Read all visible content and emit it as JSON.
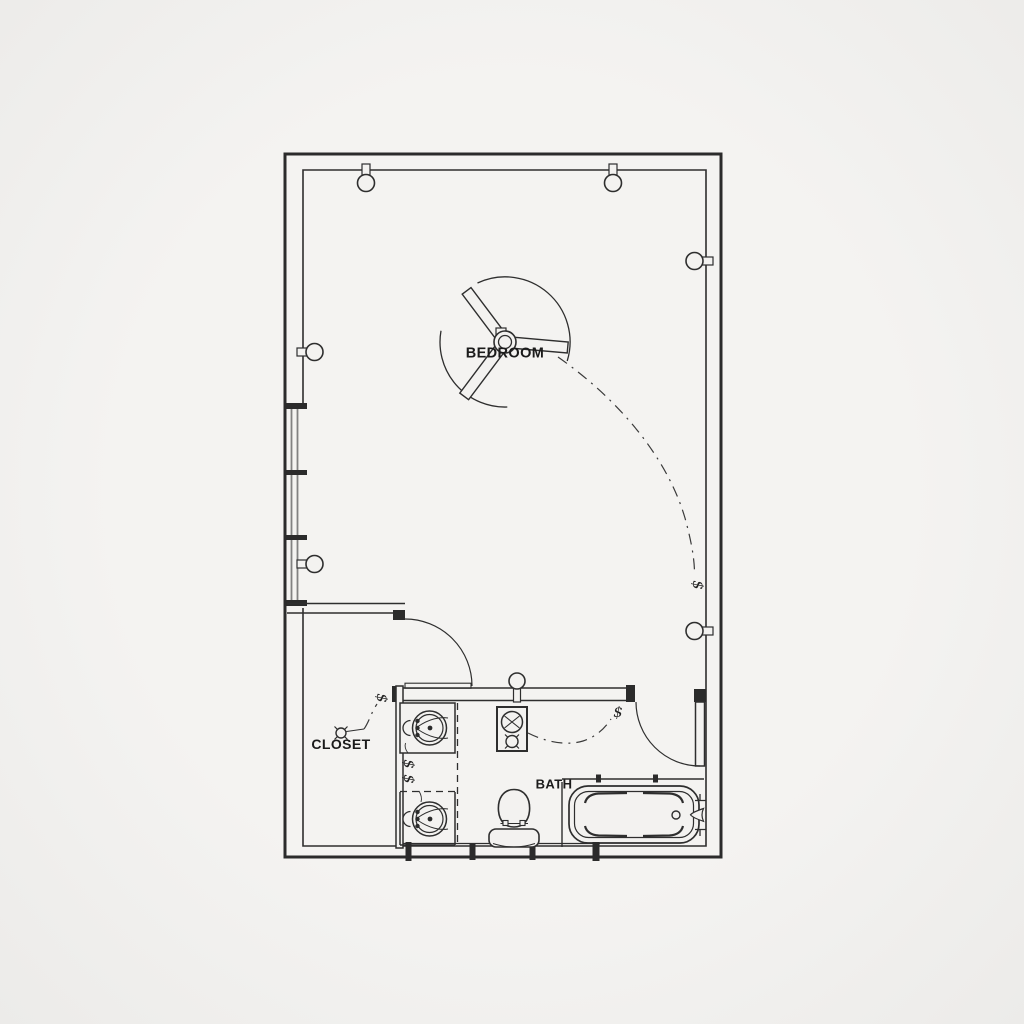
{
  "colors": {
    "background": "#f3f2f0",
    "line": "#2b2b2b",
    "glazing_gray": "#828282",
    "text": "#1b1b1b"
  },
  "rooms": {
    "bedroom": {
      "label": "BEDROOM"
    },
    "closet": {
      "label": "CLOSET"
    },
    "bath": {
      "label": "BATH"
    }
  },
  "electrical": {
    "switch_glyph": "$",
    "switches": [
      {
        "id": "closet-switch",
        "label": "$",
        "location": "at closet door jamb"
      },
      {
        "id": "vanity-switch-upper",
        "label": "$",
        "location": "between vanity sinks"
      },
      {
        "id": "vanity-switch-lower",
        "label": "$",
        "location": "between vanity sinks"
      },
      {
        "id": "bath-switch",
        "label": "$",
        "location": "at bath door"
      },
      {
        "id": "bedroom-switch",
        "label": "$",
        "location": "right wall near bath door"
      }
    ],
    "fixtures": [
      "ceiling-fan",
      "wall-sconce-top-left",
      "wall-sconce-top-right",
      "wall-sconce-right-upper",
      "wall-sconce-right-lower",
      "wall-sconce-left-upper",
      "wall-sconce-left-lower",
      "closet-ceiling-light",
      "bath-wall-light",
      "exhaust-fan-with-light"
    ]
  },
  "plumbing_fixtures": [
    "vanity-sink-upper",
    "vanity-sink-lower",
    "toilet",
    "bathtub"
  ],
  "architecture": [
    "exterior-walls",
    "left-wall-window",
    "closet-door-swing",
    "bath-door-swing"
  ]
}
